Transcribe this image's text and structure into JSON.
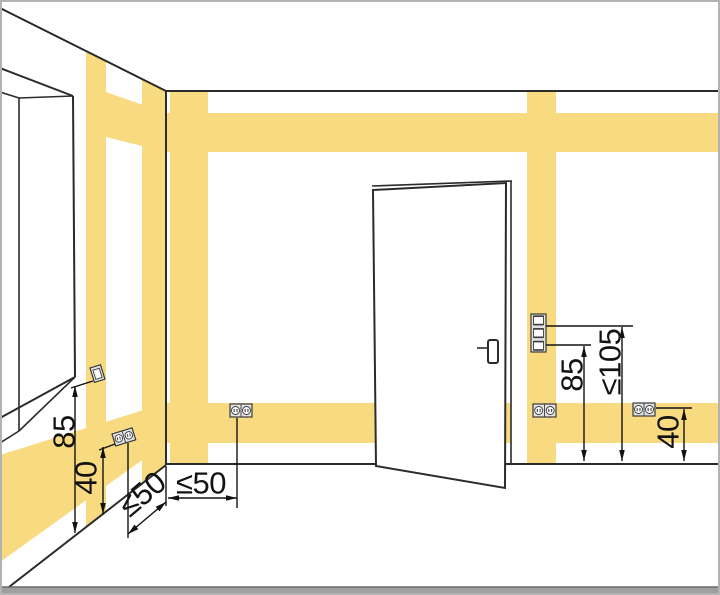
{
  "colors": {
    "zone": "#F8DA80",
    "line": "#2b2b2b",
    "dim": "#121212",
    "device-fill": "#e2e2e2",
    "device-stroke": "#3a3a3a",
    "floor-strip": "#9f9f9f",
    "strip-edge": "#6a6a6a",
    "border": "#b3b3b3"
  },
  "dimensions": {
    "window_switch_height": "85",
    "left_socket_height": "40",
    "left_corner_distance": "≤50",
    "back_corner_distance": "≤50",
    "door_switch_height": "85",
    "door_switch_max_height": "≤105",
    "right_socket_height": "40"
  }
}
